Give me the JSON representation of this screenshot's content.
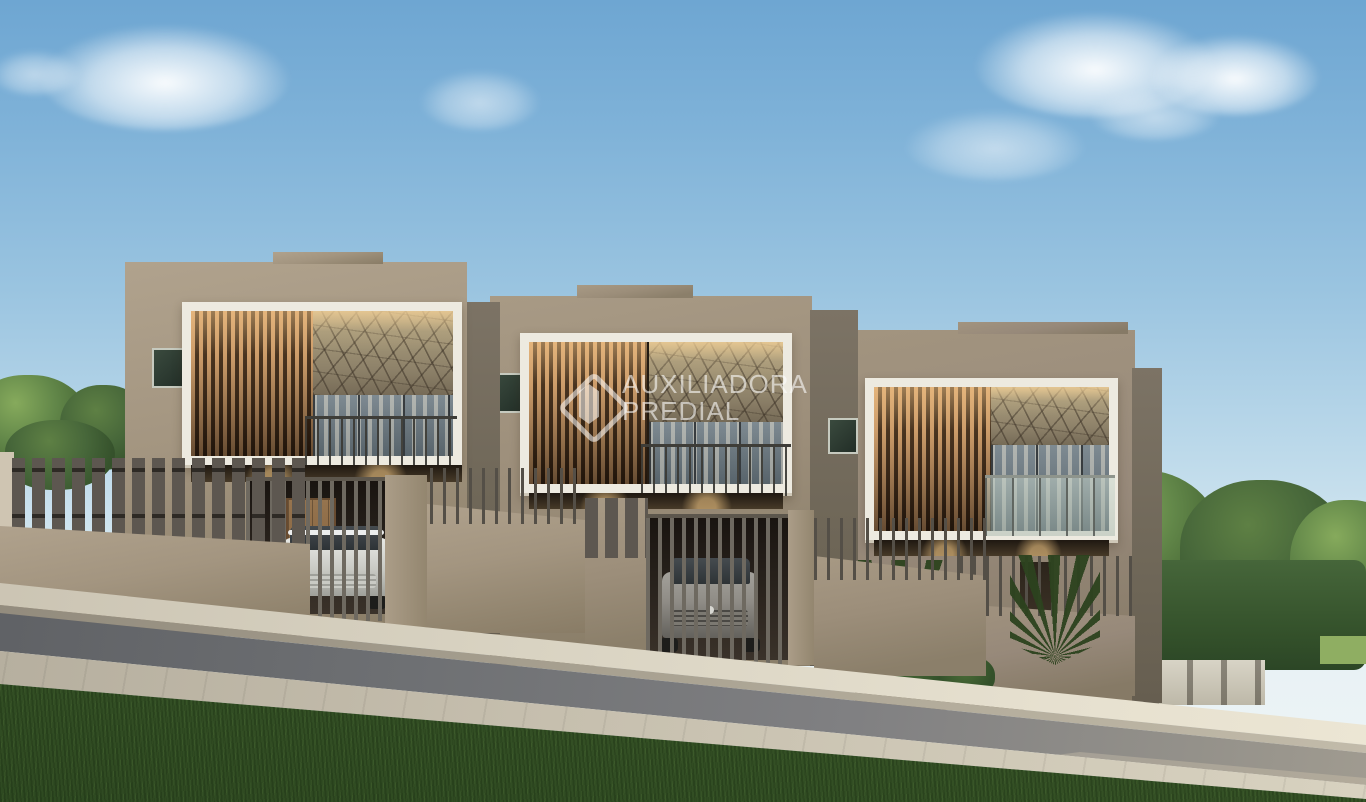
{
  "watermark": {
    "line1": "AUXILIADORA",
    "line2": "PREDIAL",
    "logo": "diamond-gem-logo"
  },
  "scene": {
    "type": "architectural-render",
    "subject": "three modern two-story townhouses on sloped street",
    "house_count": "3",
    "car_count": "2"
  },
  "palette": {
    "sky_top": "#6ea6d2",
    "sky_mid": "#a9cce1",
    "sky_horizon": "#eff5f6",
    "wall": "#a39580",
    "wall_side": "#6f6758",
    "trim": "#edeae0",
    "wood_slat": "#c49768",
    "stone": "#9a8e76",
    "glass": "#66737b",
    "fence": "#6e6960",
    "road": "#797a7c",
    "sidewalk": "#d5cfbf",
    "grass": "#47632f",
    "tree": "#55793c",
    "watermark": "rgba(255,255,255,0.58)"
  }
}
